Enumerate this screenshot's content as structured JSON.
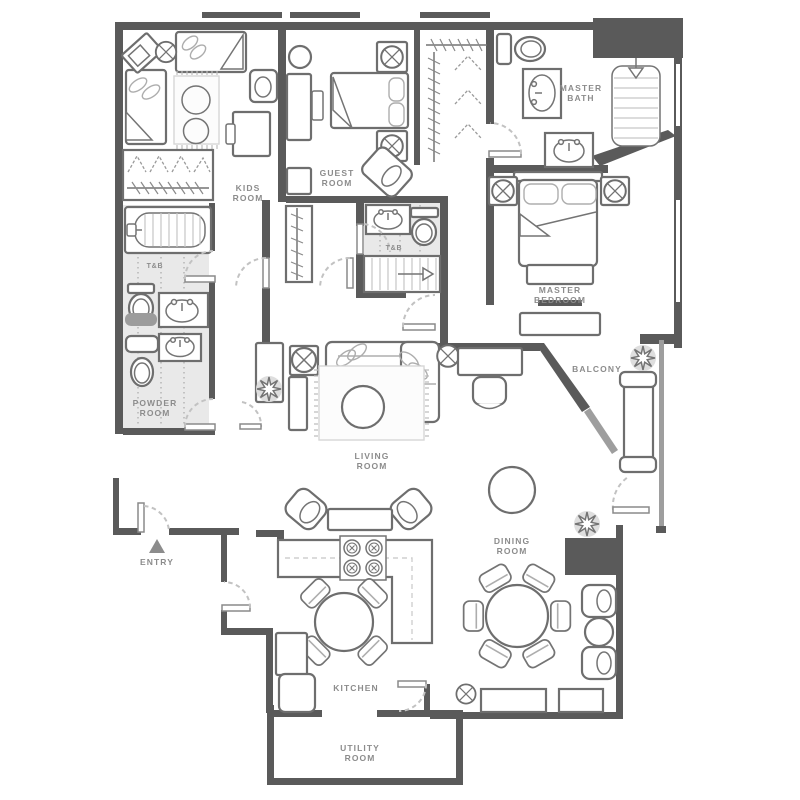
{
  "plan": {
    "type": "apartment-floor-plan",
    "colors": {
      "background": "#ffffff",
      "wall": "#5a5a5a",
      "balcony_wall": "#9e9e9e",
      "furniture_outline": "#6e6e6e",
      "bath_floor": "#e9e9e9",
      "label_text": "#8c8c8c",
      "door_arc": "#c2c2c2",
      "dark_cabinet": "#5a5a5a"
    },
    "rooms": {
      "kids_room": {
        "lines": [
          "KIDS",
          "ROOM"
        ]
      },
      "guest_room": {
        "lines": [
          "GUEST",
          "ROOM"
        ]
      },
      "master_bath": {
        "lines": [
          "MASTER",
          "BATH"
        ]
      },
      "master_bedroom": {
        "lines": [
          "MASTER",
          "BEDROOM"
        ]
      },
      "tb_main": {
        "lines": [
          "T&B"
        ]
      },
      "tb_guest": {
        "lines": [
          "T&B"
        ]
      },
      "powder_room": {
        "lines": [
          "POWDER",
          "ROOM"
        ]
      },
      "living_room": {
        "lines": [
          "LIVING",
          "ROOM"
        ]
      },
      "dining_room": {
        "lines": [
          "DINING",
          "ROOM"
        ]
      },
      "balcony": {
        "lines": [
          "BALCONY"
        ]
      },
      "kitchen": {
        "lines": [
          "KITCHEN"
        ]
      },
      "utility_room": {
        "lines": [
          "UTILITY",
          "ROOM"
        ]
      },
      "entry": {
        "lines": [
          "ENTRY"
        ]
      }
    },
    "icons": {
      "lamp": "circle-with-x-lamp-icon",
      "plant": "eight-petal-plant-icon",
      "entry_marker": "entry-triangle-icon",
      "stair_arrow": "direction-arrow-icon"
    }
  }
}
